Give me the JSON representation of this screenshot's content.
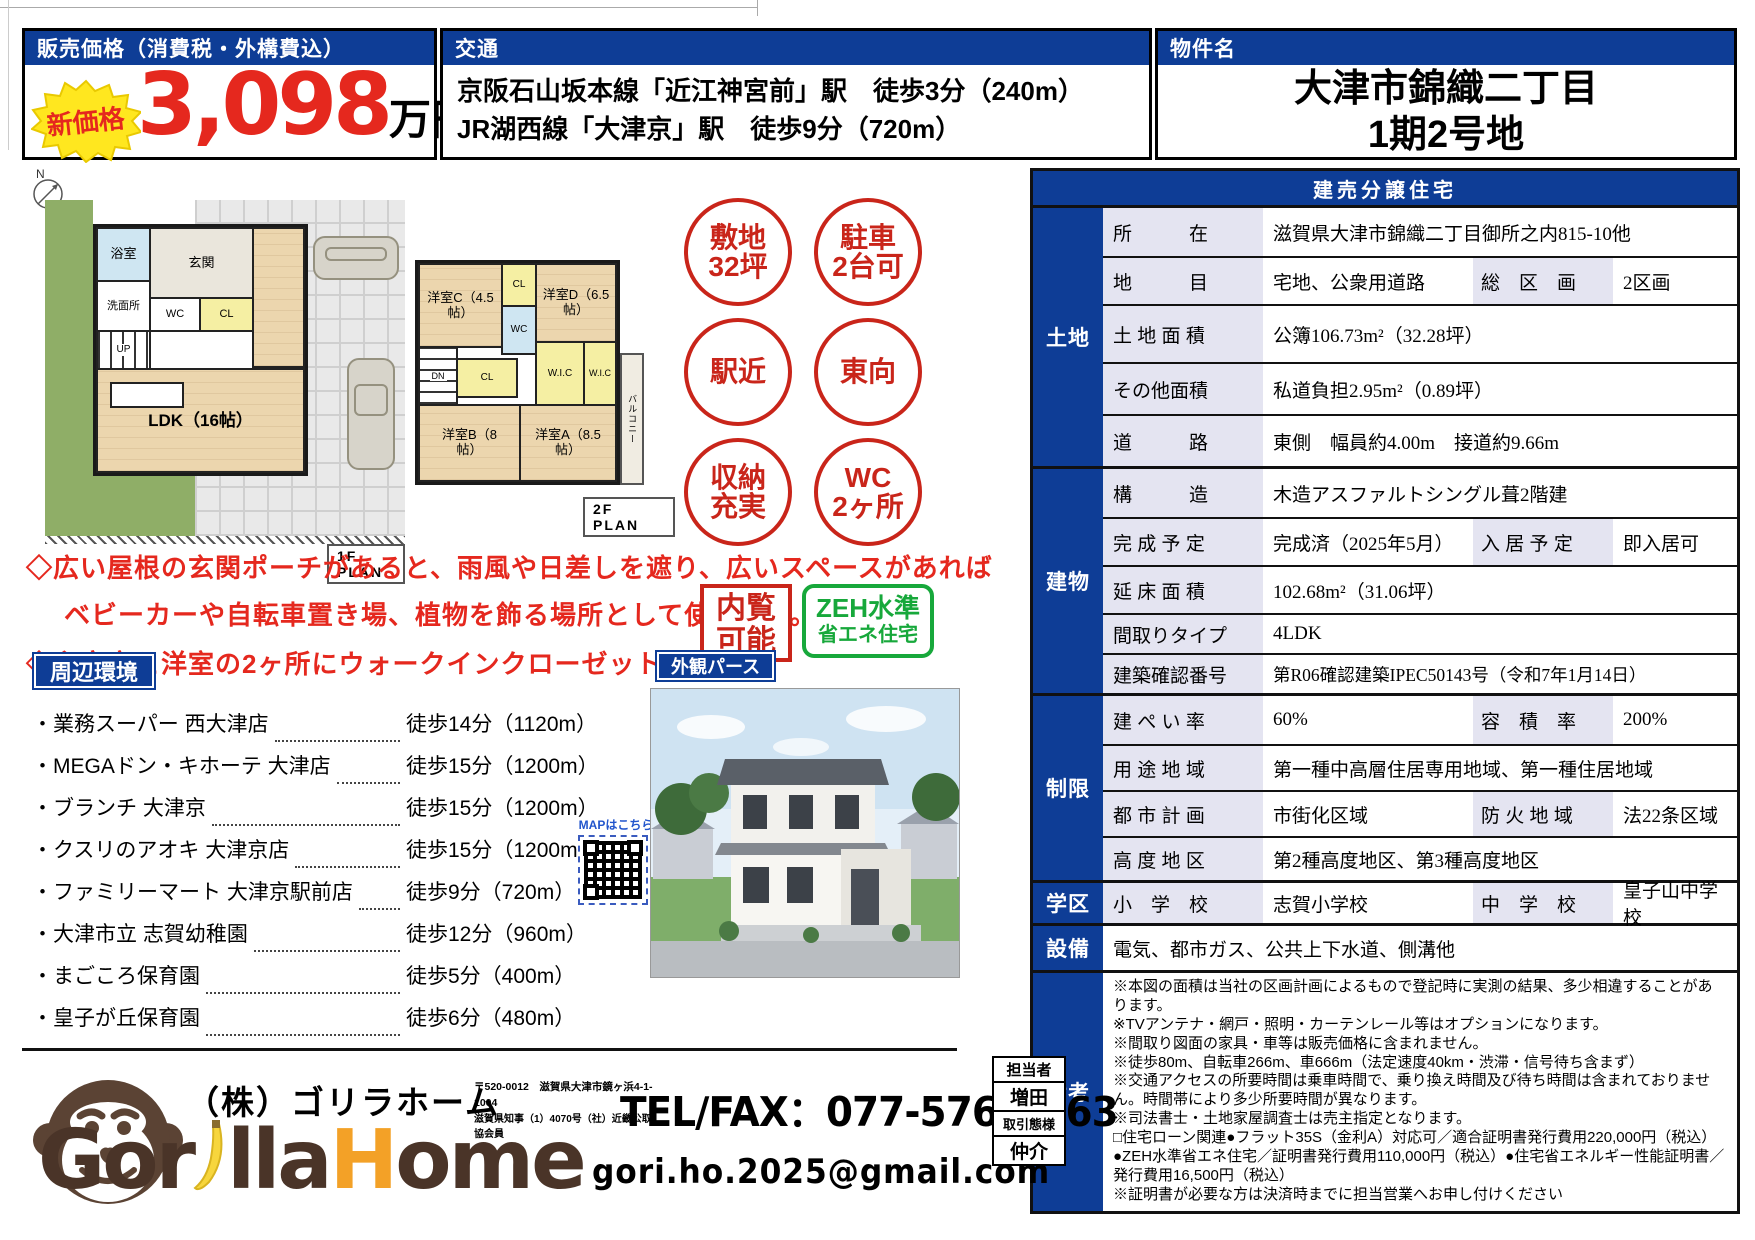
{
  "colors": {
    "accent_blue": "#0e3d96",
    "accent_red": "#e5281e",
    "badge_red": "#c9251a",
    "zeh_green": "#17a83b",
    "label_lavender": "#e4e4f1",
    "logo_brown": "#4a3428",
    "logo_orange": "#f3a127"
  },
  "header": {
    "price_title": "販売価格（消費税・外構費込）",
    "price_badge": "新価格",
    "price_value": "3,098",
    "price_unit": "万円",
    "transit_title": "交通",
    "transit_line1": "京阪石山坂本線「近江神宮前」駅　徒歩3分（240m）",
    "transit_line2": "JR湖西線「大津京」駅　徒歩9分（720m）",
    "name_title": "物件名",
    "property_name_line1": "大津市錦織二丁目",
    "property_name_line2": "1期2号地"
  },
  "compass_label": "N",
  "floorplan": {
    "f1": {
      "plan_label": "1F PLAN",
      "bath": "浴室",
      "wash": "洗面所",
      "entry": "玄関",
      "wc": "WC",
      "cl": "CL",
      "up": "UP",
      "ldk": "LDK（16帖）"
    },
    "f2": {
      "plan_label": "2F PLAN",
      "room_c": "洋室C（4.5帖）",
      "room_d": "洋室D（6.5帖）",
      "room_b": "洋室B（8帖）",
      "room_a": "洋室A（8.5帖）",
      "cl1": "CL",
      "cl2": "CL",
      "wc": "WC",
      "wic1": "W.I.C",
      "wic2": "W.I.C",
      "dn": "DN",
      "balcony": "バルコニー"
    }
  },
  "badges": {
    "items": [
      {
        "line1": "敷地",
        "line2": "32坪"
      },
      {
        "line1": "駐車",
        "line2": "2台可"
      },
      {
        "line1": "駅近",
        "line2": ""
      },
      {
        "line1": "東向",
        "line2": ""
      },
      {
        "line1": "収納",
        "line2": "充実"
      },
      {
        "line1": "WC",
        "line2": "2ヶ所"
      }
    ]
  },
  "highlights": {
    "line1": "◇広い屋根の玄関ポーチがあると、雨風や日差しを遮り、広いスペースがあれば",
    "line2": "ベビーカーや自転車置き場、植物を飾る場所として使えます。",
    "line3": "◇主寝室と洋室の2ヶ所にウォークインクローゼットを設置。"
  },
  "stamps": {
    "view_line1": "内覧",
    "view_line2": "可能",
    "zeh_line1": "ZEH水準",
    "zeh_line2": "省エネ住宅"
  },
  "surroundings": {
    "title": "周辺環境",
    "items": [
      {
        "name": "・業務スーパー 西大津店",
        "time": "徒歩14分（1120m）"
      },
      {
        "name": "・MEGAドン・キホーテ 大津店",
        "time": "徒歩15分（1200m）"
      },
      {
        "name": "・ブランチ 大津京",
        "time": "徒歩15分（1200m）"
      },
      {
        "name": "・クスリのアオキ 大津京店",
        "time": "徒歩15分（1200m）"
      },
      {
        "name": "・ファミリーマート 大津京駅前店",
        "time": "徒歩9分（720m）"
      },
      {
        "name": "・大津市立 志賀幼稚園",
        "time": "徒歩12分（960m）"
      },
      {
        "name": "・まごころ保育園",
        "time": "徒歩5分（400m）"
      },
      {
        "name": "・皇子が丘保育園",
        "time": "徒歩6分（480m）"
      }
    ]
  },
  "exterior": {
    "label": "外観パース",
    "map_label": "MAPはこちら"
  },
  "spec": {
    "title": "建売分譲住宅",
    "land": {
      "section": "土地",
      "location_label": "所　　　在",
      "location": "滋賀県大津市錦織二丁目御所之内815-10他",
      "landuse_label": "地　　　目",
      "landuse": "宅地、公衆用道路",
      "kukaku_label": "総　区　画",
      "kukaku": "2区画",
      "area_label": "土 地 面 積",
      "area": "公簿106.73m²（32.28坪）",
      "other_label": "その他面積",
      "other": "私道負担2.95m²（0.89坪）",
      "road_label": "道　　　路",
      "road": "東側　幅員約4.00m　接道約9.66m"
    },
    "building": {
      "section": "建物",
      "structure_label": "構　　　造",
      "structure": "木造アスファルトシングル葺2階建",
      "completion_label": "完 成 予 定",
      "completion": "完成済（2025年5月）",
      "movein_label": "入 居 予 定",
      "movein": "即入居可",
      "floor_area_label": "延 床 面 積",
      "floor_area": "102.68m²（31.06坪）",
      "layout_label": "間取りタイプ",
      "layout": "4LDK",
      "permit_label": "建築確認番号",
      "permit": "第R06確認建築IPEC50143号（令和7年1月14日）"
    },
    "restriction": {
      "section": "制限",
      "coverage_label": "建 ぺ い 率",
      "coverage": "60%",
      "volume_label": "容　積　率",
      "volume": "200%",
      "zoning_label": "用 途 地 域",
      "zoning": "第一種中高層住居専用地域、第一種住居地域",
      "cityplan_label": "都 市 計 画",
      "cityplan": "市街化区域",
      "fire_label": "防 火 地 域",
      "fire": "法22条区域",
      "height_label": "高 度 地 区",
      "height": "第2種高度地区、第3種高度地区"
    },
    "school": {
      "section": "学区",
      "elem_label": "小　学　校",
      "elem": "志賀小学校",
      "jhs_label": "中　学　校",
      "jhs": "皇子山中学校"
    },
    "equipment": {
      "section": "設備",
      "value": "電気、都市ガス、公共上下水道、側溝他"
    },
    "remarks": {
      "section": "備考",
      "lines": [
        "※本図の面積は当社の区画計画によるもので登記時に実測の結果、多少相違することがあります。",
        "※TVアンテナ・網戸・照明・カーテンレール等はオプションになります。",
        "※間取り図面の家具・車等は販売価格に含まれません。",
        "※徒歩80m、自転車266m、車666m（法定速度40km・渋滞・信号待ち含まず）",
        "※交通アクセスの所要時間は乗車時間で、乗り換え時間及び待ち時間は含まれておりません。時間帯により多少所要時間が異なります。",
        "※司法書士・土地家屋調査士は売主指定となります。",
        "□住宅ローン関連●フラット35S（金利A）対応可／適合証明書発行費用220,000円（税込）●ZEH水準省エネ住宅／証明書発行費用110,000円（税込）●住宅省エネルギー性能証明書／発行費用16,500円（税込）",
        "※証明書が必要な方は決済時までに担当営業へお申し付けください"
      ]
    }
  },
  "footer": {
    "company": "（株）ゴリラホーム",
    "address": "〒520-0012　滋賀県大津市鏡ヶ浜4-1-1004",
    "license": "滋賀県知事（1）4070号（社）近畿公取協会員",
    "logo_gor": "Gor",
    "logo_lla": "lla",
    "logo_h": "H",
    "logo_ome": "ome",
    "telfax": "TEL/FAX：077-576-6763",
    "email": "gori.ho.2025@gmail.com",
    "agent_label": "担当者",
    "agent_name": "増田",
    "deal_label": "取引態様",
    "deal_value": "仲介"
  }
}
